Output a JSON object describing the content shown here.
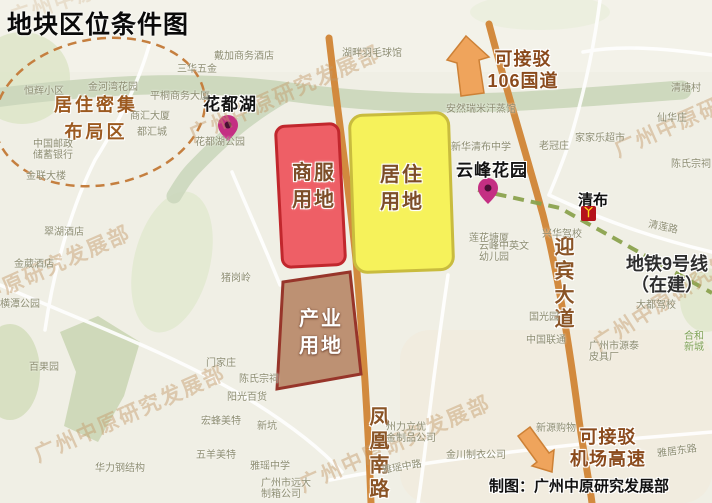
{
  "title": "地块区位条件图",
  "credit": "制图：广州中原研究发展部",
  "watermark": "广州中原研究发展部",
  "zones": {
    "commercial": {
      "label": "商服\n用地",
      "fill": "#ee5f66",
      "border": "#c1272d"
    },
    "residential": {
      "label": "居住\n用地",
      "fill": "#f6f25b",
      "border": "#c9bc3e"
    },
    "industrial": {
      "label": "产业\n用地",
      "fill": "#bd9173",
      "border": "#97352a"
    }
  },
  "annotations": {
    "dense_area": "居住密集\n布局区",
    "huadu_lake": "花都湖",
    "yunfeng_garden": "云峰花园",
    "qingbu_station": "清布",
    "metro_icon": "丫",
    "metro_line": "地铁9号线\n（在建）",
    "national_road": "可接驳\n106国道",
    "airport_expressway": "可接驳\n机场高速",
    "yingbin_avenue": "迎宾大道",
    "fenghuang_south_road": "凤凰南路"
  },
  "colors": {
    "map_bg": "#f0efe5",
    "park": "#dde5c8",
    "river": "#cbd7bc",
    "road_minor": "#ffffff",
    "road_orange": "#d28a3e",
    "metro_line": "#8ba24e",
    "arrow_fill": "#efa45c",
    "arrow_border": "#cd8136",
    "pin": "#c42f83",
    "pin_dot": "#4a0f35",
    "station_bg": "#b5121b",
    "station_glyph": "#ffd918",
    "ellipse": "#c57f3f",
    "dense_text": "#9c5a20",
    "road_label": "#8a5426",
    "watermark": "#c49b6a"
  },
  "map_labels": [
    "恒辉小区",
    "金河湾花园",
    "平桐商务大厦",
    "三华五金",
    "商汇大厦",
    "都汇城",
    "中国邮政\n储蓄银行",
    "金联大楼",
    "翠湖酒店",
    "金葳酒店",
    "横潭公园",
    "百果园",
    "猪岗岭",
    "门家庄",
    "陈氏宗祠",
    "阳光百货",
    "宏蜂美特",
    "五羊美特",
    "华力钢结构",
    "戴加商务酒店",
    "湖畔羽毛球馆",
    "花都湖公园",
    "安然瑞米汗蒸馆",
    "清塘村",
    "仙华庄",
    "家家乐超市",
    "新华清布中学",
    "老冠庄",
    "陈氏宗祠",
    "莲花塘厦",
    "云峰中英文\n幼儿园",
    "兴华驾校",
    "清莲路",
    "国光园",
    "中国联通",
    "大都驾校",
    "广州市源泰\n皮具厂",
    "合和新城",
    "新源购物",
    "雅居东路",
    "雅瑶中路",
    "金川制衣公司",
    "州力立优\n金制品公司",
    "新坑",
    "雅瑶中学",
    "广州市远大\n制箱公司"
  ]
}
